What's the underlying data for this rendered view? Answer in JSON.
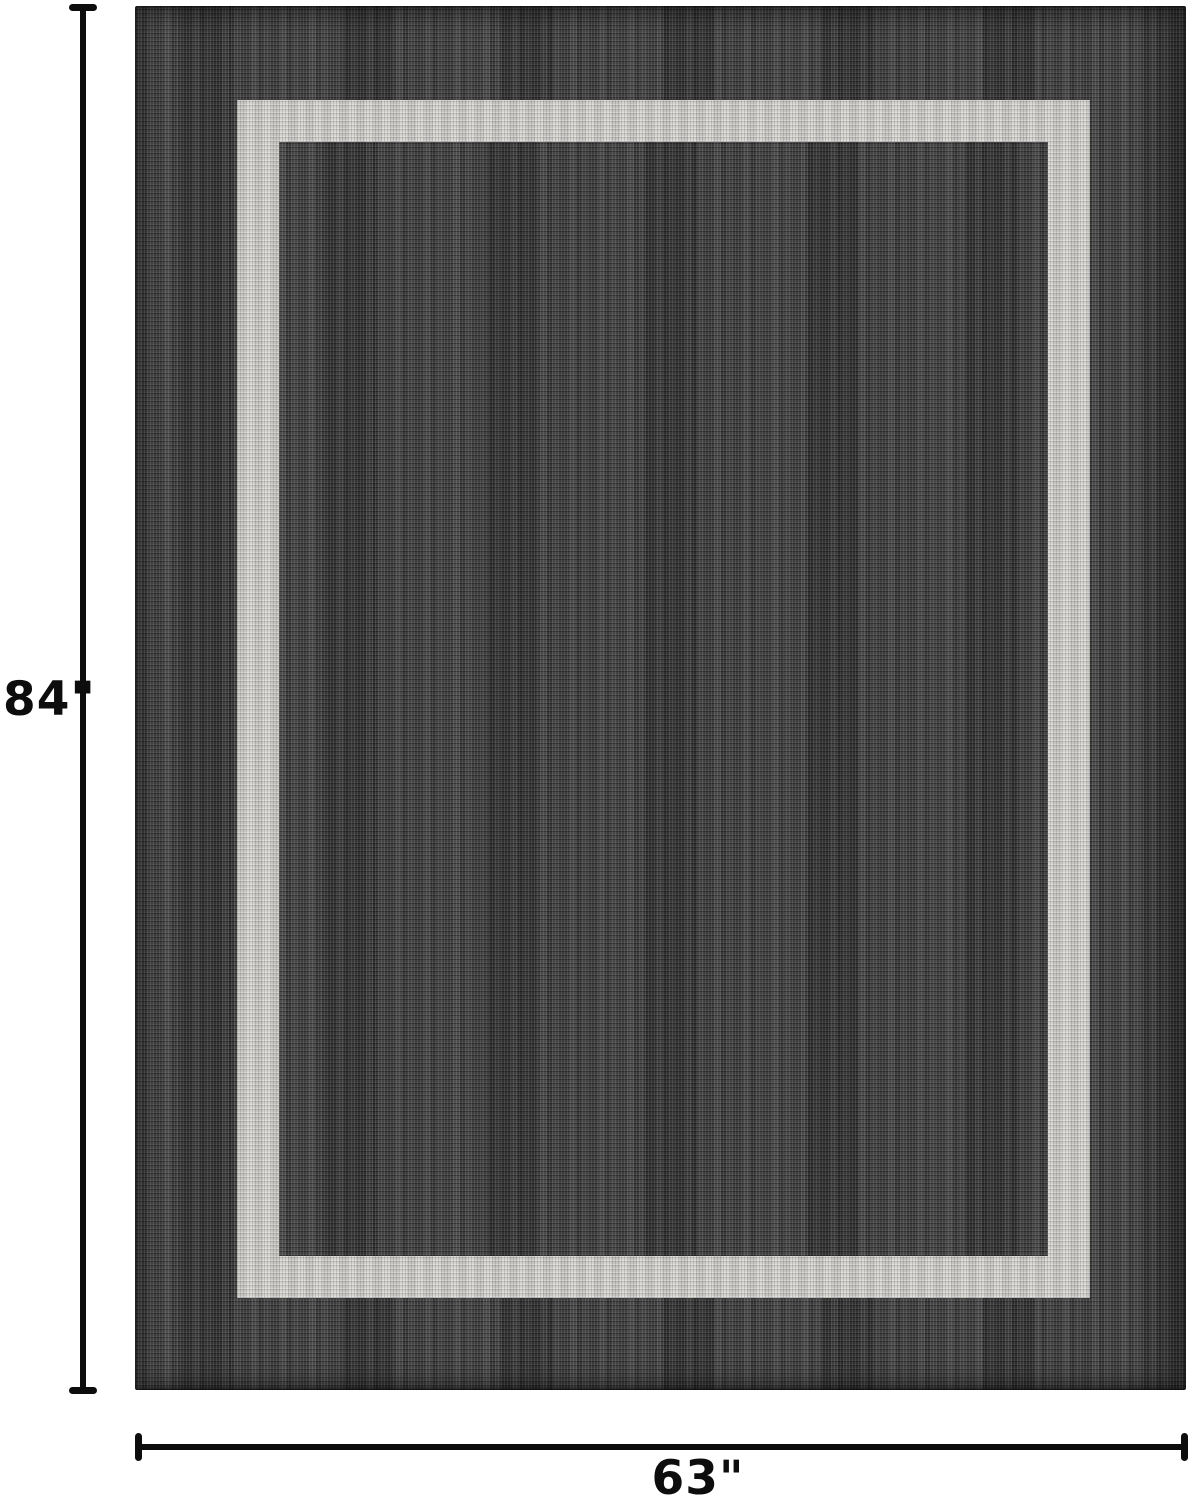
{
  "figure": {
    "type": "rug-dimension-diagram",
    "height_label": "84\"",
    "width_label": "63\"",
    "colors": {
      "background": "#ffffff",
      "rug_base": "#3a3a3a",
      "rug_fleck_light": "#9a9a9a",
      "rug_fleck_dark": "#1f1f1f",
      "border_band": "#d2d0cc",
      "dimension": "#0d0d0d"
    }
  }
}
